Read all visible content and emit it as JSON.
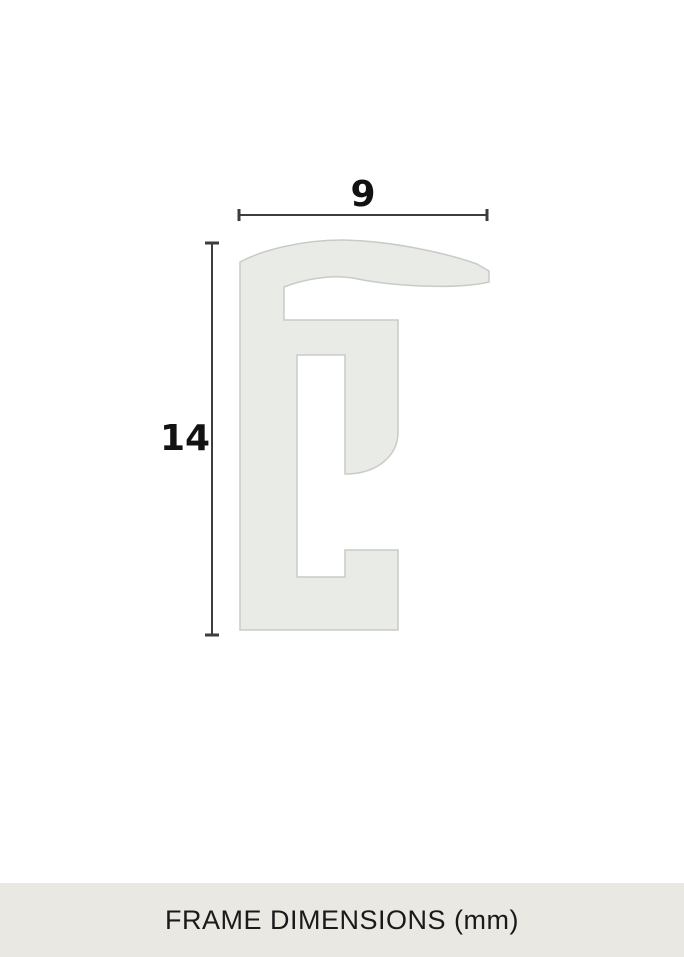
{
  "page": {
    "background": "#ffffff"
  },
  "diagram": {
    "width_value": "9",
    "height_value": "14",
    "profile_fill": "#e9ebe6",
    "profile_stroke": "#c9cbc8",
    "dimension_color": "#3d3d3d",
    "label_color": "#121212"
  },
  "footer": {
    "label": "FRAME DIMENSIONS (mm)",
    "background": "#e9e8e3",
    "text_color": "#1a1a1a"
  }
}
